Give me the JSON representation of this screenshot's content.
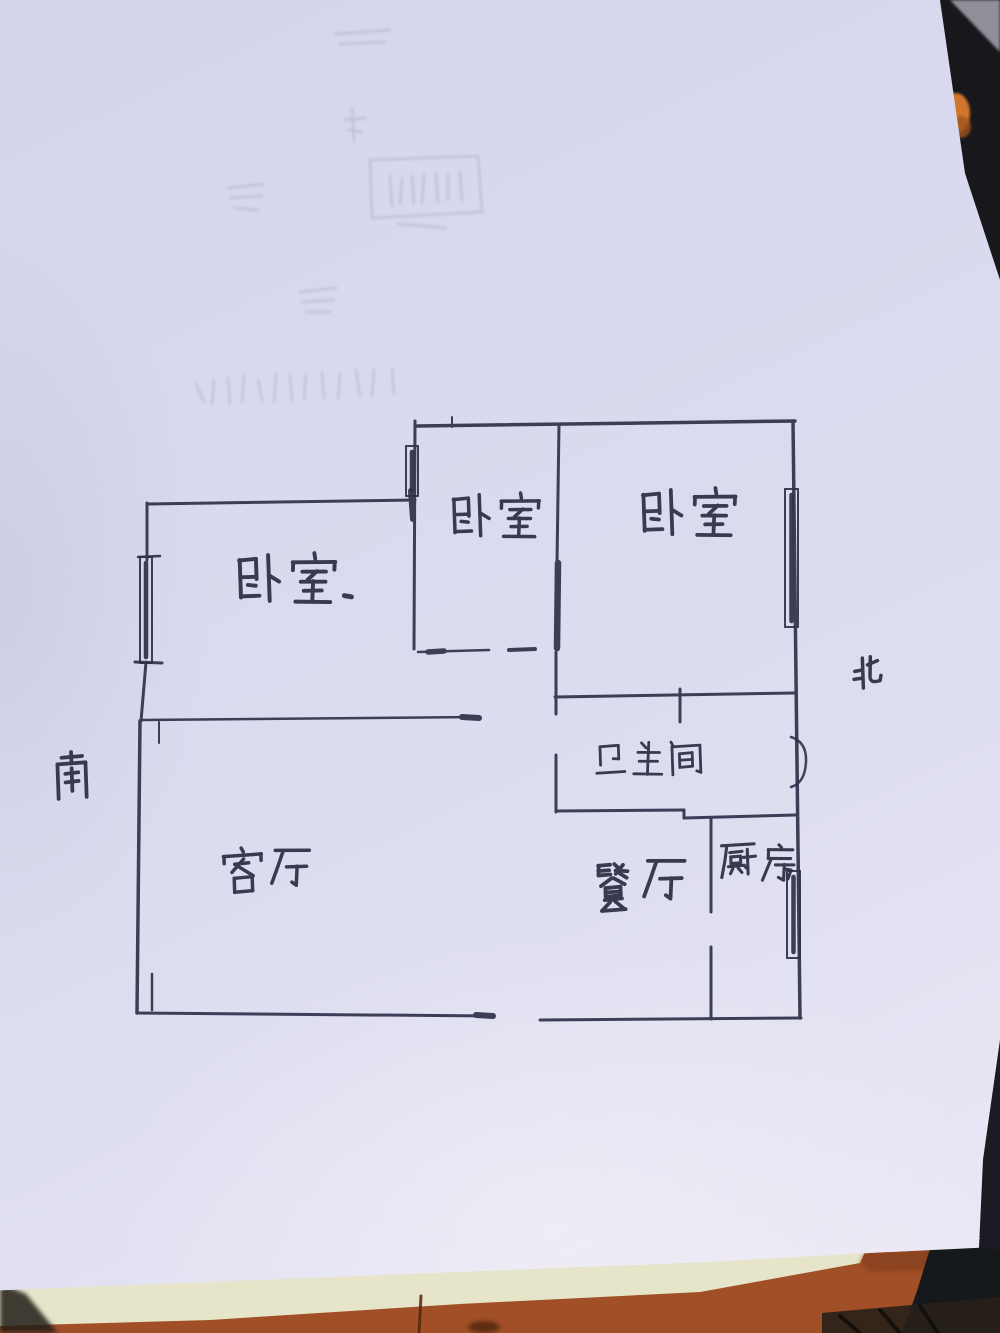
{
  "photo": {
    "subject": "hand-drawn apartment floor plan on paper",
    "colors": {
      "pen": "#30304a",
      "paper_tint": "#d9d9ef",
      "desk_dark": "#17171c",
      "wood": "#a14f26",
      "cream_sheet": "#e6e4c9",
      "orange_object": "#d0772b",
      "gray_corner": "#8f8f99"
    }
  },
  "scene": {
    "shapes": [
      {
        "name": "desk-dark-background",
        "type": "rect",
        "x": 0,
        "y": 0,
        "w": 1000,
        "h": 1333,
        "fill": "#17171c"
      },
      {
        "name": "desk-gray-corner",
        "type": "polygon",
        "points": "950,0 1000,0 1000,52",
        "fill": "#8f8f99",
        "cls": "soft1"
      },
      {
        "name": "orange-object",
        "type": "ellipse",
        "cx": 956,
        "cy": 113,
        "rx": 14,
        "ry": 20,
        "fill": "#d0772b",
        "cls": "soft1"
      },
      {
        "name": "orange-object-shade",
        "type": "ellipse",
        "cx": 961,
        "cy": 127,
        "rx": 10,
        "ry": 11,
        "fill": "#a3551c",
        "opacity": 0.8,
        "cls": "soft1"
      },
      {
        "name": "paper-stack-sheet",
        "type": "rect",
        "x": 0,
        "y": 1238,
        "w": 1000,
        "h": 95,
        "fill": "#e6e4c9"
      },
      {
        "name": "wood-desk-surface",
        "type": "polygon",
        "points": "0,1326 210,1320 460,1304 700,1292 860,1263 865,1252 1000,1246 1000,1333 0,1333",
        "fill": "#a14f26"
      },
      {
        "name": "wood-crack",
        "type": "line",
        "x1": 421,
        "y1": 1296,
        "x2": 419,
        "y2": 1333,
        "stroke": "#55260e",
        "w": 3,
        "opacity": 0.85
      },
      {
        "name": "wood-knot",
        "type": "ellipse",
        "cx": 484,
        "cy": 1327,
        "rx": 16,
        "ry": 6,
        "fill": "#43200d",
        "opacity": 0.7,
        "cls": "soft"
      },
      {
        "name": "wood-shade-right",
        "type": "polygon",
        "points": "860,1263 865,1252 1000,1246 1000,1268 870,1272",
        "fill": "#7c3a1a",
        "opacity": 0.55,
        "cls": "soft"
      },
      {
        "name": "dark-object-bottom-right",
        "type": "polygon",
        "points": "932,1242 1000,1237 1000,1333 902,1333 918,1288",
        "fill": "#16191b"
      },
      {
        "name": "dark-tread-strip",
        "type": "polygon",
        "points": "822,1313 1000,1297 1000,1333 822,1333",
        "fill": "#282019",
        "opacity": 0.9
      },
      {
        "name": "tread-ridge-1",
        "type": "line",
        "x1": 840,
        "y1": 1316,
        "x2": 860,
        "y2": 1333,
        "stroke": "#0f0c0a",
        "w": 4,
        "opacity": 0.8
      },
      {
        "name": "tread-ridge-2",
        "type": "line",
        "x1": 880,
        "y1": 1310,
        "x2": 900,
        "y2": 1333,
        "stroke": "#0f0c0a",
        "w": 4,
        "opacity": 0.8
      },
      {
        "name": "tread-ridge-3",
        "type": "line",
        "x1": 920,
        "y1": 1306,
        "x2": 938,
        "y2": 1333,
        "stroke": "#0f0c0a",
        "w": 4,
        "opacity": 0.8
      },
      {
        "name": "right-edge-dark-strip",
        "type": "polygon",
        "points": "987,1040 1000,1034 1000,1250 980,1248",
        "fill": "#1b1b22"
      },
      {
        "name": "shadow-bottom-left",
        "type": "polygon",
        "points": "0,1283 26,1294 58,1333 0,1333",
        "fill": "#241e18",
        "opacity": 0.85,
        "cls": "soft"
      }
    ]
  },
  "floor_plan": {
    "pen_color": "#30304a",
    "label_color": "#2c2c42",
    "rooms": [
      {
        "id": "bedroom-left",
        "label": "卧室",
        "x": 148,
        "y": 502,
        "w": 267,
        "h": 220,
        "label_x": 232,
        "label_y": 552,
        "char_size": 56,
        "suffix_dot": true
      },
      {
        "id": "bedroom-middle",
        "label": "卧室",
        "x": 415,
        "y": 423,
        "w": 143,
        "h": 229,
        "label_x": 447,
        "label_y": 492,
        "char_size": 50
      },
      {
        "id": "bedroom-right",
        "label": "卧室",
        "x": 558,
        "y": 423,
        "w": 237,
        "h": 274,
        "label_x": 636,
        "label_y": 487,
        "char_size": 54
      },
      {
        "id": "bathroom",
        "label": "卫生间",
        "x": 556,
        "y": 697,
        "w": 127,
        "h": 115,
        "label_x": 590,
        "label_y": 740,
        "char_size": 40
      },
      {
        "id": "living-room",
        "label": "客厅",
        "x": 140,
        "y": 722,
        "w": 340,
        "h": 291,
        "label_x": 218,
        "label_y": 843,
        "char_size": 50,
        "char_dy": [
          4,
          0
        ]
      },
      {
        "id": "dining-room",
        "label": "餐厅",
        "x": 480,
        "y": 697,
        "w": 231,
        "h": 321,
        "label_x": 586,
        "label_y": 862,
        "char_size": 54,
        "char_dy": [
          0,
          -9
        ]
      },
      {
        "id": "kitchen",
        "label": "厨房",
        "x": 711,
        "y": 818,
        "w": 84,
        "h": 200,
        "label_x": 716,
        "label_y": 840,
        "char_size": 44,
        "char_dy": [
          0,
          4
        ]
      }
    ],
    "compass": [
      {
        "id": "south",
        "label": "南",
        "x": 45,
        "y": 752,
        "char_size": 54
      },
      {
        "id": "north",
        "label": "北",
        "x": 840,
        "y": 652,
        "char_size": 50
      }
    ],
    "walls": [
      [
        417,
        426,
        795,
        421,
        3.5
      ],
      [
        793,
        421,
        800,
        1018,
        3.5
      ],
      [
        559,
        424,
        557,
        563,
        3
      ],
      [
        558,
        563,
        557,
        648,
        6.5
      ],
      [
        415,
        421,
        414,
        649,
        3
      ],
      [
        148,
        504,
        415,
        500,
        3
      ],
      [
        147,
        503,
        147,
        560,
        3
      ],
      [
        146,
        662,
        141,
        721,
        3
      ],
      [
        140,
        721,
        137,
        1013,
        3.5
      ],
      [
        141,
        720,
        478,
        717,
        2.5
      ],
      [
        462,
        717,
        479,
        718,
        6
      ],
      [
        159,
        722,
        159,
        743,
        2
      ],
      [
        152,
        974,
        152,
        1010,
        2.5
      ],
      [
        137,
        1013,
        492,
        1016,
        3
      ],
      [
        476,
        1015,
        493,
        1016,
        6
      ],
      [
        540,
        1020,
        801,
        1018,
        3
      ],
      [
        418,
        652,
        489,
        650,
        2.5
      ],
      [
        428,
        652,
        444,
        651,
        5.5
      ],
      [
        509,
        650,
        535,
        649,
        4
      ],
      [
        556,
        652,
        556,
        714,
        3
      ],
      [
        556,
        755,
        556,
        812,
        3
      ],
      [
        555,
        697,
        794,
        693,
        3
      ],
      [
        680,
        689,
        680,
        722,
        3
      ],
      [
        556,
        811,
        684,
        810,
        3
      ],
      [
        684,
        810,
        684,
        818,
        3
      ],
      [
        684,
        818,
        795,
        815,
        3
      ],
      [
        711,
        818,
        711,
        912,
        3
      ],
      [
        711,
        947,
        711,
        1019,
        3
      ],
      [
        452,
        417,
        452,
        427,
        2
      ],
      [
        138,
        557,
        160,
        556,
        2.5
      ],
      [
        135,
        662,
        162,
        663,
        3
      ],
      [
        411,
        491,
        413,
        519,
        6
      ]
    ],
    "windows": [
      {
        "name": "window-bedroom-left",
        "x": 140,
        "y": 557,
        "w": 12,
        "h": 106
      },
      {
        "name": "window-bedroom-middle",
        "x": 406,
        "y": 446,
        "w": 12,
        "h": 50
      },
      {
        "name": "window-bedroom-right",
        "x": 785,
        "y": 489,
        "w": 13,
        "h": 138
      },
      {
        "name": "window-kitchen",
        "x": 787,
        "y": 871,
        "w": 13,
        "h": 87
      }
    ],
    "doors": [
      {
        "name": "entry-door-arc",
        "d": "M 791,737 Q 807,742 806,762 Q 805,783 791,787"
      }
    ],
    "ghost_marks": [
      "M370,160 L478,156 L482,212 L372,218 Z",
      "M390,176 L392,206 M402,178 L400,204 M412,176 L414,204 M424,175 L422,203 M436,174 L438,202 M448,174 L448,200 M460,172 L462,200",
      "M398,224 L446,228",
      "M352,108 L354,142 M344,120 L366,118 M348,130 L362,132",
      "M228,188 L264,184 M230,198 L262,196 M234,208 L258,210",
      "M300,292 L336,288 M302,302 L334,300 M306,312 L330,312",
      "M196,384 L204,402 M214,380 L212,404 M228,378 L230,404 M244,376 L242,402 M258,380 L262,400 M276,374 L274,402 M290,376 L292,400 M306,374 L304,400 M322,372 L324,398 M340,374 L338,398 M356,370 L360,396 M374,370 L372,396 M392,368 L394,394",
      "M336,34 L390,30 M340,44 L384,42"
    ]
  }
}
